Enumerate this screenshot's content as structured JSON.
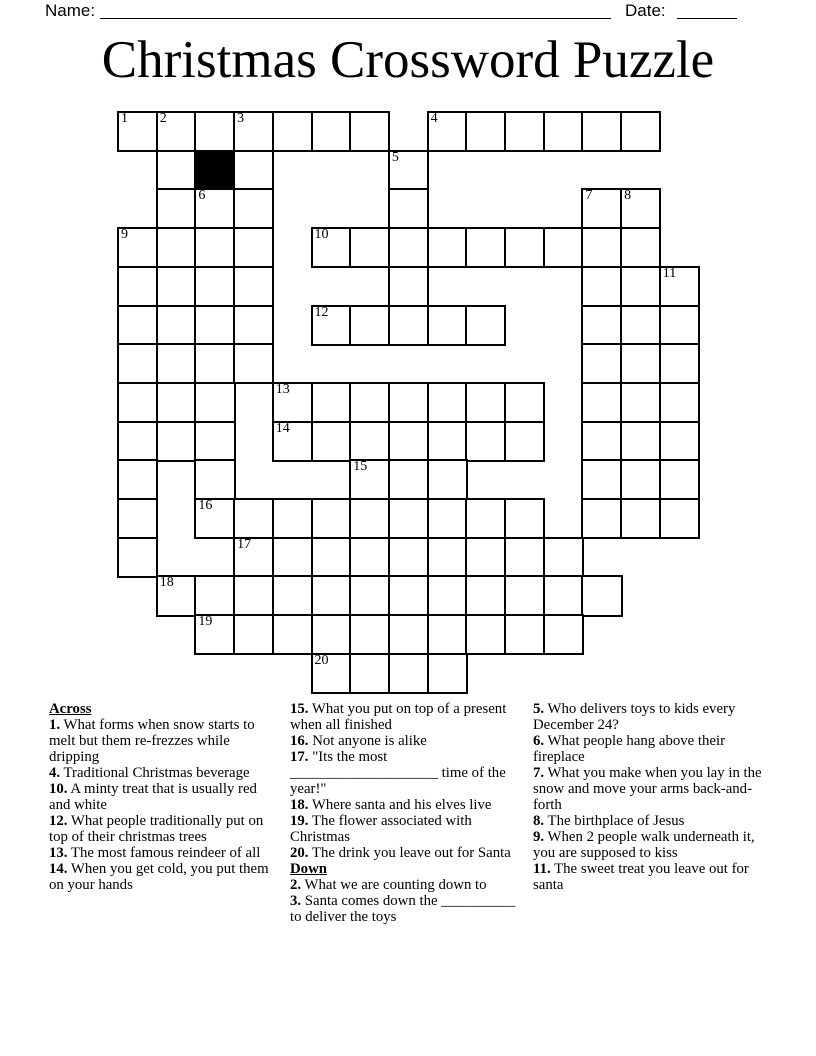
{
  "header": {
    "name_label": "Name:",
    "date_label": "Date:"
  },
  "title": "Christmas Crossword Puzzle",
  "grid": {
    "rows": 15,
    "cols": 15,
    "row_runs": [
      [
        [
          0,
          6
        ],
        [
          8,
          13
        ]
      ],
      [
        [
          1,
          3
        ],
        [
          7,
          7
        ]
      ],
      [
        [
          1,
          3
        ],
        [
          7,
          7
        ],
        [
          12,
          13
        ]
      ],
      [
        [
          0,
          3
        ],
        [
          5,
          13
        ]
      ],
      [
        [
          0,
          3
        ],
        [
          7,
          7
        ],
        [
          12,
          14
        ]
      ],
      [
        [
          0,
          3
        ],
        [
          5,
          9
        ],
        [
          12,
          14
        ]
      ],
      [
        [
          0,
          3
        ],
        [
          12,
          14
        ]
      ],
      [
        [
          0,
          2
        ],
        [
          4,
          10
        ],
        [
          12,
          14
        ]
      ],
      [
        [
          0,
          2
        ],
        [
          4,
          10
        ],
        [
          12,
          14
        ]
      ],
      [
        [
          0,
          0
        ],
        [
          2,
          2
        ],
        [
          6,
          8
        ],
        [
          12,
          14
        ]
      ],
      [
        [
          0,
          0
        ],
        [
          2,
          10
        ],
        [
          12,
          14
        ]
      ],
      [
        [
          0,
          0
        ],
        [
          3,
          11
        ]
      ],
      [
        [
          1,
          12
        ]
      ],
      [
        [
          2,
          11
        ]
      ],
      [
        [
          5,
          8
        ]
      ]
    ],
    "black_cells": [
      [
        1,
        2
      ]
    ],
    "numbers": [
      {
        "num": "1",
        "r": 0,
        "c": 0
      },
      {
        "num": "2",
        "r": 0,
        "c": 1
      },
      {
        "num": "3",
        "r": 0,
        "c": 3
      },
      {
        "num": "4",
        "r": 0,
        "c": 8
      },
      {
        "num": "5",
        "r": 1,
        "c": 7
      },
      {
        "num": "6",
        "r": 2,
        "c": 2
      },
      {
        "num": "7",
        "r": 2,
        "c": 12
      },
      {
        "num": "8",
        "r": 2,
        "c": 13
      },
      {
        "num": "9",
        "r": 3,
        "c": 0
      },
      {
        "num": "10",
        "r": 3,
        "c": 5
      },
      {
        "num": "11",
        "r": 4,
        "c": 14
      },
      {
        "num": "12",
        "r": 5,
        "c": 5
      },
      {
        "num": "13",
        "r": 7,
        "c": 4
      },
      {
        "num": "14",
        "r": 8,
        "c": 4
      },
      {
        "num": "15",
        "r": 9,
        "c": 6
      },
      {
        "num": "16",
        "r": 10,
        "c": 2
      },
      {
        "num": "17",
        "r": 11,
        "c": 3
      },
      {
        "num": "18",
        "r": 12,
        "c": 1
      },
      {
        "num": "19",
        "r": 13,
        "c": 2
      },
      {
        "num": "20",
        "r": 14,
        "c": 5
      }
    ]
  },
  "clues": {
    "across_label": "Across",
    "down_label": "Down",
    "across": [
      {
        "num": "1",
        "text": "What forms when snow starts to melt but them re-frezzes while dripping"
      },
      {
        "num": "4",
        "text": "Traditional Christmas beverage"
      },
      {
        "num": "10",
        "text": "A minty treat that is usually red and white"
      },
      {
        "num": "12",
        "text": "What people traditionally put on top of their christmas trees"
      },
      {
        "num": "13",
        "text": "The most famous reindeer of all"
      },
      {
        "num": "14",
        "text": "When you get cold, you put them on your hands"
      },
      {
        "num": "15",
        "text": "What you put on top of a present when all finished"
      },
      {
        "num": "16",
        "text": "Not anyone is alike"
      },
      {
        "num": "17",
        "text": "\"Its the most ____________________ time of the year!\""
      },
      {
        "num": "18",
        "text": "Where santa and his elves live"
      },
      {
        "num": "19",
        "text": "The flower associated with Christmas"
      },
      {
        "num": "20",
        "text": "The drink you leave out for Santa"
      }
    ],
    "down": [
      {
        "num": "2",
        "text": "What we are counting down to"
      },
      {
        "num": "3",
        "text": "Santa comes down the __________ to deliver the toys"
      },
      {
        "num": "5",
        "text": "Who delivers toys to kids every December 24?"
      },
      {
        "num": "6",
        "text": "What people hang above their fireplace"
      },
      {
        "num": "7",
        "text": "What you make when you lay in the snow and move your arms back-and-forth"
      },
      {
        "num": "8",
        "text": "The birthplace of Jesus"
      },
      {
        "num": "9",
        "text": "When 2 people walk underneath it, you are supposed to kiss"
      },
      {
        "num": "11",
        "text": "The sweet treat you leave out for santa"
      }
    ]
  },
  "colors": {
    "ink": "#000000",
    "paper": "#ffffff"
  }
}
